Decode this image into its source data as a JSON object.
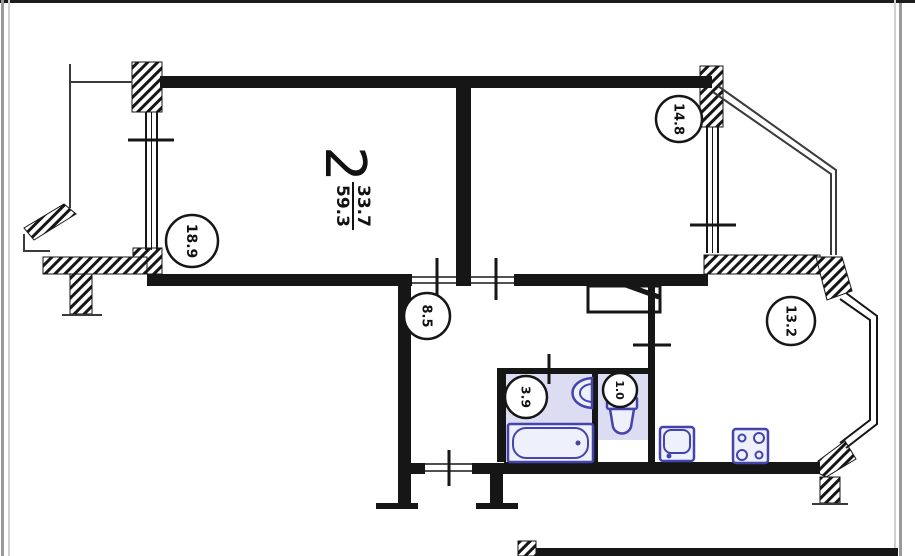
{
  "plan": {
    "summary": {
      "rooms_count": "2",
      "living_area": "33.7",
      "total_area": "59.3"
    },
    "rooms": [
      {
        "id": "living-room",
        "area": "18.9"
      },
      {
        "id": "bedroom",
        "area": "14.8"
      },
      {
        "id": "hallway",
        "area": "8.5"
      },
      {
        "id": "kitchen",
        "area": "13.2"
      },
      {
        "id": "bathroom",
        "area": "3.9"
      },
      {
        "id": "wc",
        "area": "1.0"
      }
    ],
    "fixtures": [
      "bathtub",
      "washbasin",
      "toilet",
      "kitchen-sink",
      "stove"
    ],
    "colors": {
      "wall": "#161616",
      "fixture_stroke": "#4444ac",
      "fixture_fill": "#eef0fb",
      "wet_zone_fill": "#dcdcf2",
      "page_border": "#9a9a9a"
    }
  }
}
